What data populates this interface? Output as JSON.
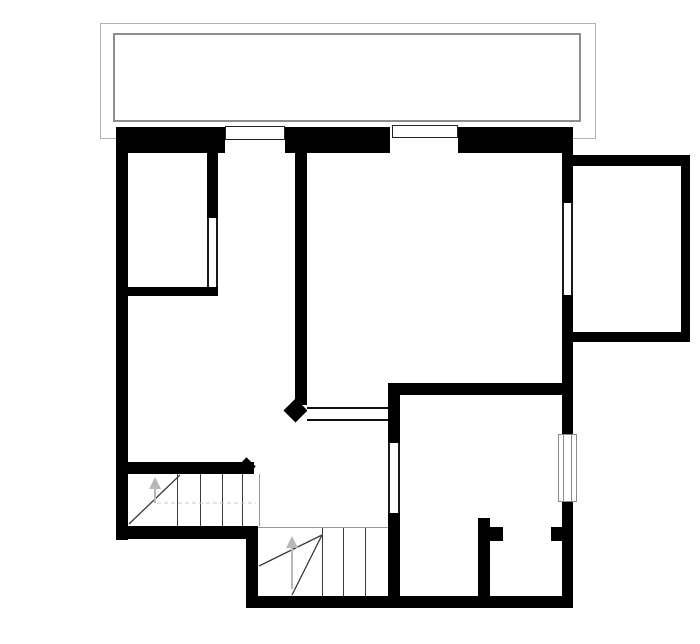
{
  "plan": {
    "kind": "architectural-floor-plan",
    "features": {
      "balcony": "balcony-outline-top",
      "bay": "right-side-bay-room",
      "upper_left_room": "room-with-interior-door",
      "living_area": "large-center-right-room",
      "lower_right_room": "room-with-window-and-closet",
      "stairs": "two-flight-winder-staircase",
      "stair_direction": "up",
      "upper_flight_treads": 4,
      "lower_flight_treads": 3,
      "top_wall_windows": 2,
      "right_wall_windows": 1
    }
  },
  "colors": {
    "wall": "#000000",
    "floor": "#ffffff",
    "balcony_outer_line": "#b2b2b2",
    "balcony_inner_line": "#8e8e8e",
    "stair_line": "#3a3a3a",
    "stair_edge_line": "#999999",
    "walk_line": "#c8c8c8",
    "arrow": "#b8b8b8",
    "window_border": "#222222",
    "window_frame": "#8a8a8a"
  }
}
